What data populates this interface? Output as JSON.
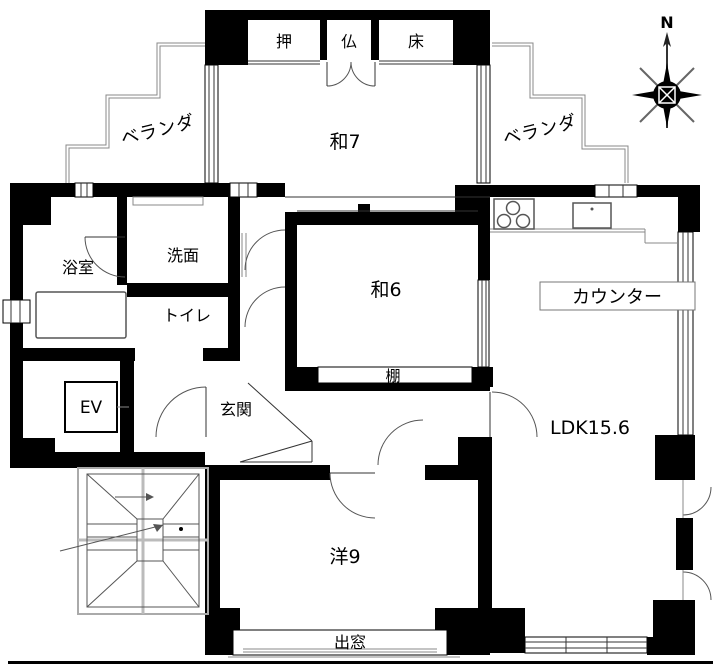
{
  "compass": {
    "north_label": "N"
  },
  "labels": {
    "veranda_left": "ベランダ",
    "veranda_right": "ベランダ",
    "oshiire": "押",
    "butsudan": "仏",
    "tokonoma": "床",
    "washitsu7": "和7",
    "washitsu6": "和6",
    "youshitsu9": "洋9",
    "ldk": "LDK15.6",
    "genkan": "玄関",
    "bathroom": "浴室",
    "washroom": "洗面",
    "toilet": "トイレ",
    "elevator": "EV",
    "counter": "カウンター",
    "shelf": "棚",
    "bay_window": "出窓"
  },
  "colors": {
    "wall": "#000000",
    "background": "#ffffff",
    "thin_line": "#555555",
    "veranda_line": "#999999"
  }
}
